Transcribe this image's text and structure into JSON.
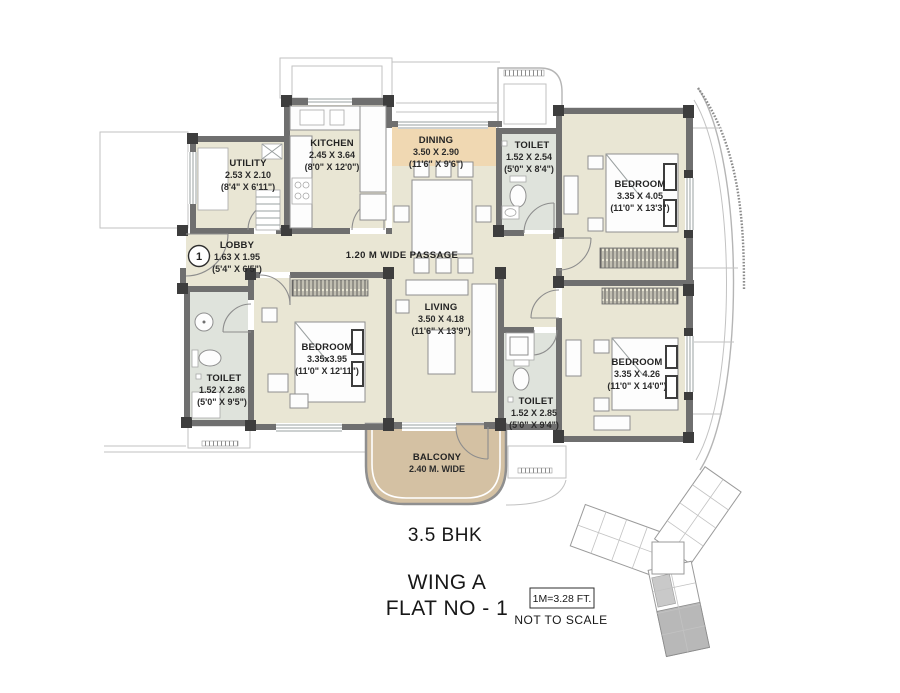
{
  "colors": {
    "background": "#ffffff",
    "floor": "#e9e6d4",
    "toilet_floor": "#dfe3dc",
    "dining_band": "#f0d8b2",
    "balcony": "#d4c1a3",
    "wall": "#6f6f6f",
    "wall_dark": "#3d3d3d",
    "text": "#232323",
    "keyplan_highlight": "#b8b8b8"
  },
  "plan": {
    "entry_marker": "1",
    "passage_label": "1.20 M WIDE PASSAGE",
    "rooms": {
      "utility": {
        "name": "UTILITY",
        "metric": "2.53 X 2.10",
        "imperial": "(8'4\" X 6'11\")"
      },
      "kitchen": {
        "name": "KITCHEN",
        "metric": "2.45 X 3.64",
        "imperial": "(8'0\" X 12'0\")"
      },
      "dining": {
        "name": "DINING",
        "metric": "3.50 X 2.90",
        "imperial": "(11'6\" X 9'6\")"
      },
      "toilet_top": {
        "name": "TOILET",
        "metric": "1.52 X 2.54",
        "imperial": "(5'0\" X 8'4\")"
      },
      "bedroom_top": {
        "name": "BEDROOM",
        "metric": "3.35 X 4.05",
        "imperial": "(11'0\" X 13'3\")"
      },
      "lobby": {
        "name": "LOBBY",
        "metric": "1.63 X 1.95",
        "imperial": "(5'4\" X 6'5\")"
      },
      "toilet_left": {
        "name": "TOILET",
        "metric": "1.52 X 2.86",
        "imperial": "(5'0\" X 9'5\")"
      },
      "bedroom_left": {
        "name": "BEDROOM",
        "metric": "3.35x3.95",
        "imperial": "(11'0\" X 12'11\")"
      },
      "living": {
        "name": "LIVING",
        "metric": "3.50 X 4.18",
        "imperial": "(11'6\" X 13'9\")"
      },
      "toilet_bottom": {
        "name": "TOILET",
        "metric": "1.52 X 2.85",
        "imperial": "(5'0\" X 9'4\")"
      },
      "bedroom_bottom": {
        "name": "BEDROOM",
        "metric": "3.35 X 4.26",
        "imperial": "(11'0\" X 14'0\")"
      },
      "balcony": {
        "name": "BALCONY",
        "metric": "2.40 M. WIDE"
      }
    }
  },
  "footer": {
    "unit_type": "3.5 BHK",
    "wing": "WING A",
    "flat": "FLAT NO - 1"
  },
  "scale": {
    "conversion": "1M=3.28 FT.",
    "note": "NOT TO SCALE"
  }
}
